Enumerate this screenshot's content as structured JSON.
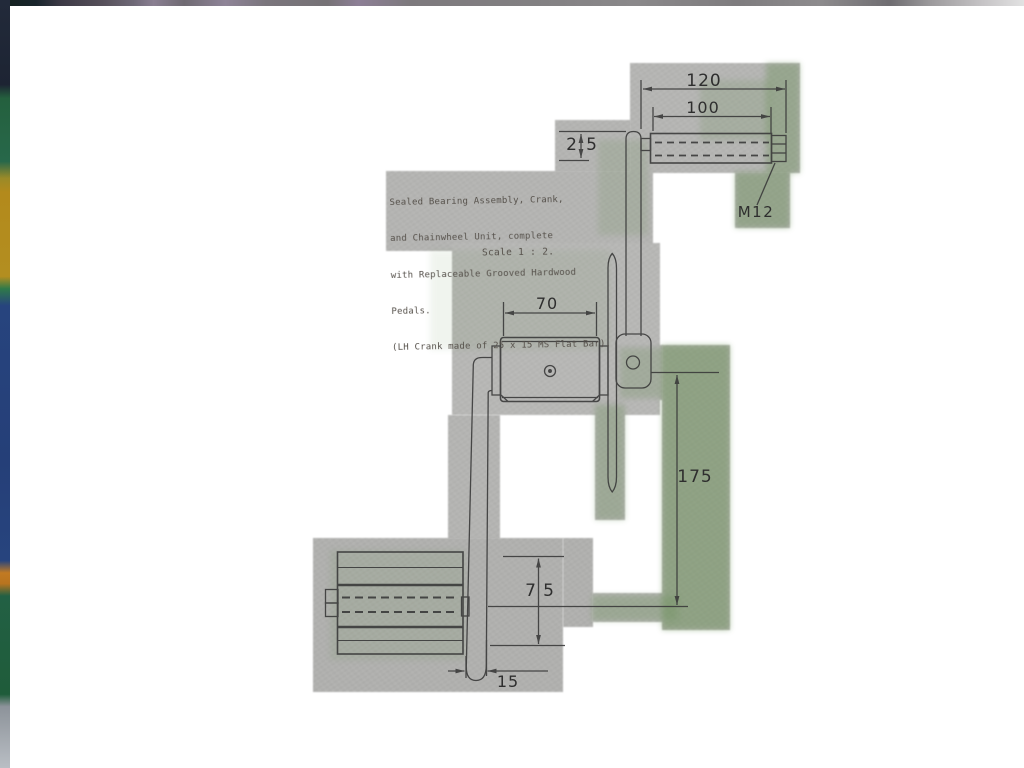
{
  "document": {
    "kind": "scanned engineering drawing",
    "subject": "Sealed bearing crank and chainwheel unit"
  },
  "note": {
    "lines": [
      "Sealed Bearing Assembly, Crank,",
      "and Chainwheel Unit, complete",
      "with Replaceable Grooved Hardwood",
      "Pedals.",
      "(LH Crank made of 25 x 15 MS Flat Bar)."
    ],
    "scale_note": "Scale 1 : 2."
  },
  "dimensions": {
    "pedal_overall_length": "120",
    "pedal_body_length": "100",
    "crank_bar_width": {
      "left_digit": "2",
      "right_digit": "5"
    },
    "bearing_housing_length": "70",
    "crank_length": "175",
    "pedal_diameter": {
      "left_digit": "7",
      "right_digit": "5"
    },
    "crank_bar_thickness": "15",
    "spindle_thread": "M12"
  },
  "colors": {
    "scan_gray": "#b4b4b2",
    "scan_green_tint": "#648c50",
    "line_ink": "#3a3a3a",
    "page": "#ffffff"
  }
}
